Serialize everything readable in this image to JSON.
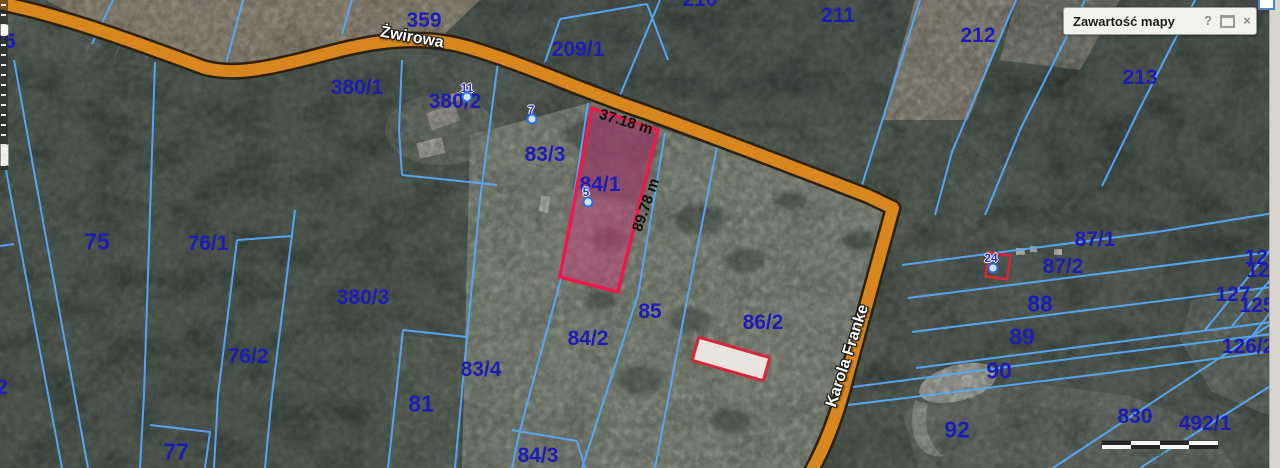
{
  "panel": {
    "title": "Zawartość mapy",
    "help_icon": "?",
    "close_icon": "×"
  },
  "scalebar": {
    "labels": [
      {
        "text": "0",
        "x": 4
      },
      {
        "text": "30",
        "x": 61
      },
      {
        "text": "60 m",
        "x": 114
      }
    ]
  },
  "map": {
    "label_color": "#1d1db5",
    "street_labels": [
      {
        "text": "Żwirowa",
        "x": 412,
        "y": 38,
        "rotate": 10
      },
      {
        "text": "Karola Franke",
        "x": 848,
        "y": 356,
        "rotate": -72
      }
    ],
    "measurements": [
      {
        "text": "37.18 m",
        "x": 626,
        "y": 122,
        "rotate": 17
      },
      {
        "text": "89.78 m",
        "x": 646,
        "y": 205,
        "rotate": -71
      }
    ],
    "markers": [
      {
        "text": "11",
        "x": 467,
        "y": 88,
        "dx": 467,
        "dy": 97
      },
      {
        "text": "7",
        "x": 531,
        "y": 110,
        "dx": 532,
        "dy": 119
      },
      {
        "text": "5",
        "x": 586,
        "y": 192,
        "dx": 588,
        "dy": 202
      },
      {
        "text": "24",
        "x": 991,
        "y": 258,
        "dx": 993,
        "dy": 268
      }
    ],
    "parcel_labels": [
      {
        "text": "75",
        "x": 4,
        "y": 42
      },
      {
        "text": "359",
        "x": 424,
        "y": 21
      },
      {
        "text": "210",
        "x": 700,
        "y": 0
      },
      {
        "text": "209/1",
        "x": 578,
        "y": 50
      },
      {
        "text": "211",
        "x": 838,
        "y": 16
      },
      {
        "text": "212",
        "x": 978,
        "y": 36
      },
      {
        "text": "213",
        "x": 1140,
        "y": 78
      },
      {
        "text": "380/1",
        "x": 357,
        "y": 88
      },
      {
        "text": "380/2",
        "x": 455,
        "y": 102
      },
      {
        "text": "83/3",
        "x": 545,
        "y": 155
      },
      {
        "text": "84/1",
        "x": 600,
        "y": 185
      },
      {
        "text": "75",
        "x": 97,
        "y": 242,
        "size": 23
      },
      {
        "text": "76/1",
        "x": 208,
        "y": 244
      },
      {
        "text": "380/3",
        "x": 363,
        "y": 298
      },
      {
        "text": "76/2",
        "x": 248,
        "y": 357
      },
      {
        "text": "83/4",
        "x": 481,
        "y": 370
      },
      {
        "text": "81",
        "x": 421,
        "y": 404,
        "size": 23
      },
      {
        "text": "77",
        "x": 176,
        "y": 452,
        "size": 23
      },
      {
        "text": "84/2",
        "x": 588,
        "y": 339
      },
      {
        "text": "85",
        "x": 650,
        "y": 312
      },
      {
        "text": "84/3",
        "x": 538,
        "y": 456
      },
      {
        "text": "86/2",
        "x": 763,
        "y": 323
      },
      {
        "text": "87/1",
        "x": 1095,
        "y": 240
      },
      {
        "text": "87/2",
        "x": 1063,
        "y": 267
      },
      {
        "text": "88",
        "x": 1040,
        "y": 304,
        "size": 23
      },
      {
        "text": "89",
        "x": 1022,
        "y": 337,
        "size": 23
      },
      {
        "text": "90",
        "x": 999,
        "y": 371,
        "size": 23
      },
      {
        "text": "92",
        "x": 957,
        "y": 430,
        "size": 23
      },
      {
        "text": "830",
        "x": 1135,
        "y": 417
      },
      {
        "text": "492/1",
        "x": 1205,
        "y": 424
      },
      {
        "text": "124",
        "x": 1262,
        "y": 258
      },
      {
        "text": "126",
        "x": 1264,
        "y": 271
      },
      {
        "text": "127",
        "x": 1233,
        "y": 295
      },
      {
        "text": "125",
        "x": 1257,
        "y": 306
      },
      {
        "text": "126/2",
        "x": 1248,
        "y": 347
      },
      {
        "text": "2",
        "x": 2,
        "y": 388
      }
    ]
  }
}
